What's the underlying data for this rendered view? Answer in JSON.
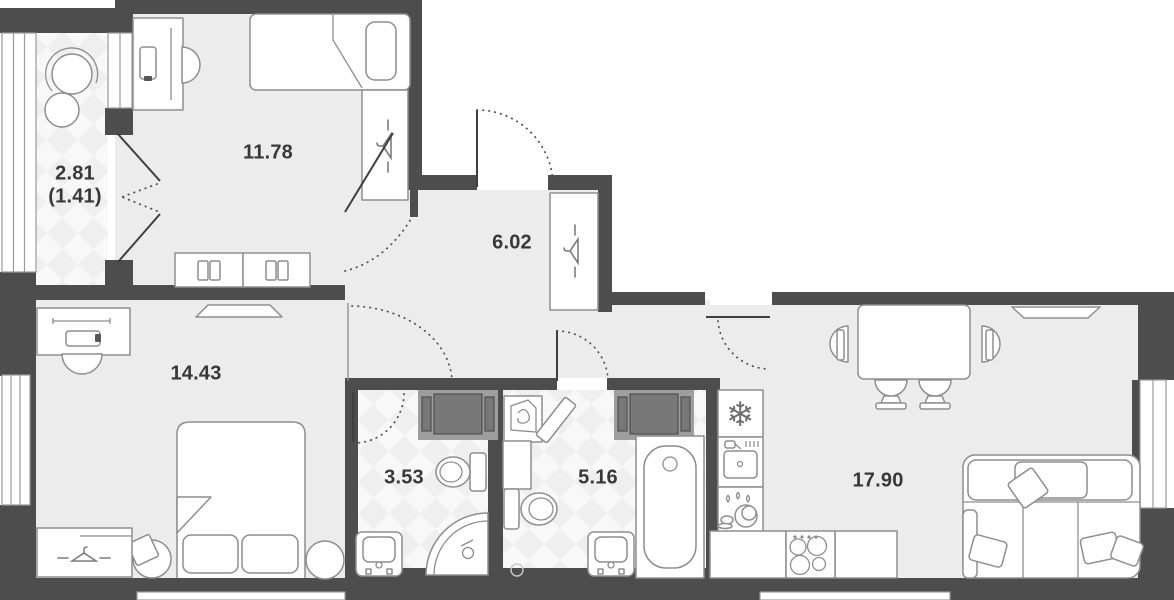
{
  "title_hint": "apartment-floor-plan",
  "colors": {
    "wall": "#4d4d4d",
    "floor": "#ececec",
    "wet_floor_checker": "#efefef",
    "furniture_line": "#8e8e8e",
    "label_text": "#383838"
  },
  "rooms": [
    {
      "key": "loggia",
      "area_label": "2.81",
      "secondary_label": "(1.41)"
    },
    {
      "key": "bedroom-small",
      "area_label": "11.78"
    },
    {
      "key": "hallway",
      "area_label": "6.02"
    },
    {
      "key": "bedroom-master",
      "area_label": "14.43"
    },
    {
      "key": "shower-room",
      "area_label": "3.53"
    },
    {
      "key": "bathroom",
      "area_label": "5.16"
    },
    {
      "key": "kitchen-living",
      "area_label": "17.90"
    }
  ],
  "icons": {
    "snowflake": "❄"
  }
}
